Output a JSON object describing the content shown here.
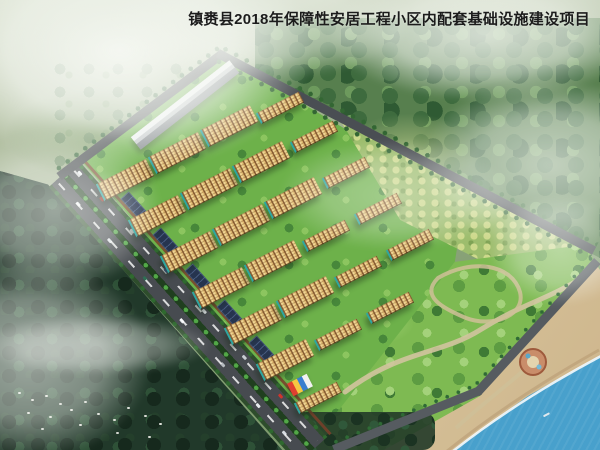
{
  "title": "镇赉县2018年保障性安居工程小区内配套基础设施建设项目",
  "scene": {
    "kind": "aerial architectural rendering of a residential housing development beside a lake",
    "palette": {
      "title_text": "#1c1c1c",
      "roof_orange": "#d4562a",
      "roof_shadow_red": "#a83418",
      "facade_cream": "#f0d694",
      "window_brown": "#8a5f35",
      "teal_accent": "#2fa6a0",
      "lawn_green": "#6db14a",
      "park_green": "#7eba52",
      "orchard_green": "#9dbd6d",
      "forest_dark": "#21392a",
      "forest_mid": "#577f4e",
      "hills_sage": "#a8b797",
      "road_asphalt": "#474b50",
      "parking_navy": "#26344f",
      "commercial_grey": "#c3c7cb",
      "path_tan": "#d2c49e",
      "sand": "#d9c59c",
      "water_blue": "#2f86b8",
      "mist_white": "#f8faf6",
      "wall_redbrown": "#7a3f2a"
    },
    "buildings": {
      "towers": [
        [
          128,
          186
        ],
        [
          160,
          222
        ],
        [
          192,
          258
        ],
        [
          224,
          294
        ],
        [
          256,
          330
        ],
        [
          288,
          366
        ],
        [
          180,
          159
        ],
        [
          212,
          195
        ],
        [
          244,
          231
        ],
        [
          276,
          267
        ],
        [
          308,
          303
        ],
        [
          232,
          132
        ],
        [
          264,
          168
        ],
        [
          296,
          204
        ]
      ],
      "slabs": [
        [
          282,
          112
        ],
        [
          316,
          141
        ],
        [
          348,
          177
        ],
        [
          380,
          213
        ],
        [
          328,
          240
        ],
        [
          412,
          249
        ],
        [
          360,
          276
        ],
        [
          392,
          312
        ],
        [
          340,
          339
        ],
        [
          320,
          402
        ]
      ],
      "parking_lots": [
        [
          138,
          210
        ],
        [
          170,
          246
        ],
        [
          202,
          282
        ],
        [
          234,
          318
        ],
        [
          266,
          354
        ]
      ],
      "commercial": [
        185,
        105
      ],
      "kindergarten": [
        300,
        385
      ]
    }
  }
}
